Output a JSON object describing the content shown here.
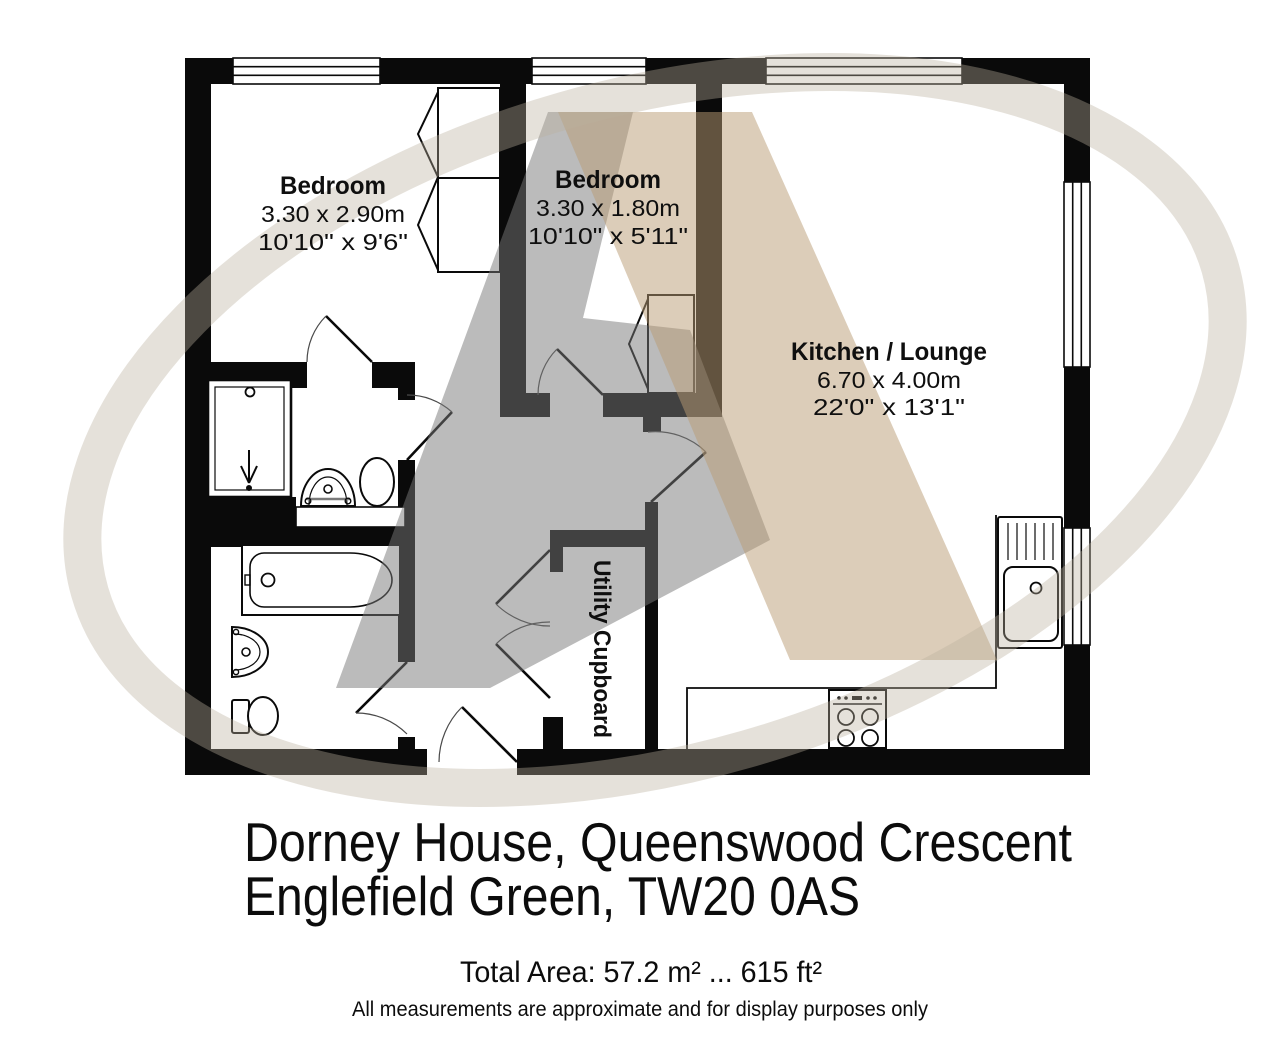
{
  "plan": {
    "rooms": [
      {
        "name": "Bedroom",
        "metric": "3.30 x 2.90m",
        "imperial": "10'10\" x 9'6\""
      },
      {
        "name": "Bedroom",
        "metric": "3.30 x 1.80m",
        "imperial": "10'10\" x 5'11\""
      },
      {
        "name": "Kitchen / Lounge",
        "metric": "6.70 x 4.00m",
        "imperial": "22'0\" x 13'1\""
      },
      {
        "name": "Utility Cupboard"
      }
    ],
    "fixtures": [
      "window-icon",
      "door-icon",
      "wardrobe-icon",
      "shower-icon",
      "sink-icon",
      "toilet-icon",
      "bathtub-icon",
      "kitchen-sink-icon",
      "hob-icon"
    ]
  },
  "footer": {
    "address_line1": "Dorney House, Queenswood Crescent",
    "address_line2": "Englefield Green, TW20 0AS",
    "total_area": "Total Area: 57.2 m² ... 615 ft²",
    "disclaimer": "All measurements are approximate and for display purposes only"
  },
  "colors": {
    "wall": "#0a0a0a",
    "watermark_gray": "rgba(120,120,120,0.5)",
    "watermark_tan": "rgba(186,156,116,0.5)",
    "watermark_swoosh": "rgba(187,177,158,0.38)",
    "text": "#0c0c0c"
  }
}
